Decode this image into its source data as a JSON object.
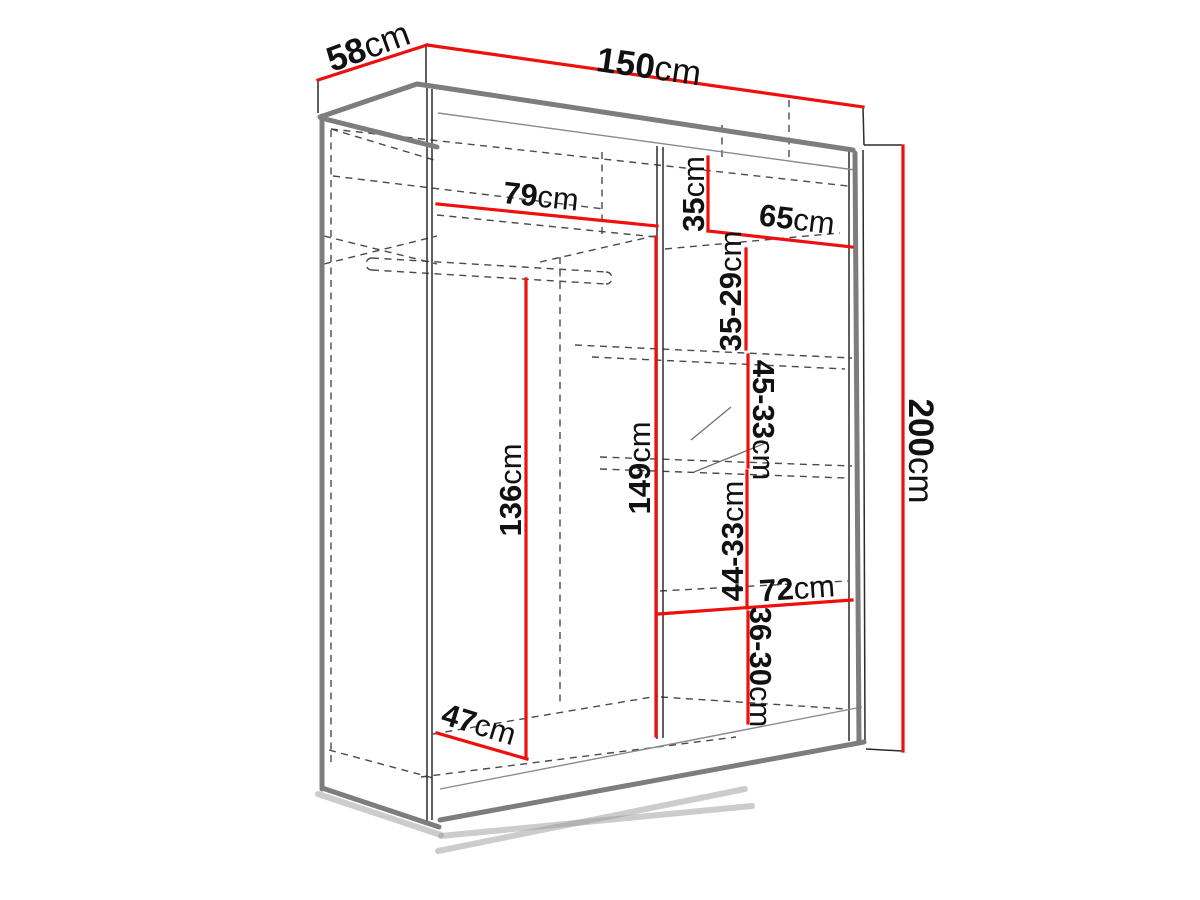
{
  "diagram": {
    "kind": "wardrobe-dimension-diagram",
    "unit": "cm"
  },
  "colors": {
    "dimension": "#ee0f0f",
    "outline": "#7d7d7d",
    "line": "#2b2b2b",
    "dashed": "#4a4a4a",
    "label": "#111111",
    "background": "#ffffff"
  },
  "labels": {
    "depth": {
      "num": "58",
      "unit": "cm"
    },
    "width": {
      "num": "150",
      "unit": "cm"
    },
    "height": {
      "num": "200",
      "unit": "cm"
    },
    "left_shelf_width": {
      "num": "79",
      "unit": "cm"
    },
    "right_shelf_width": {
      "num": "65",
      "unit": "cm"
    },
    "right_top_height": {
      "num": "35",
      "unit": "cm"
    },
    "right_gap_1": {
      "num": "35-29",
      "unit": "cm"
    },
    "right_gap_2": {
      "num": "45-33",
      "unit": "cm"
    },
    "right_gap_3": {
      "num": "44-33",
      "unit": "cm"
    },
    "bottom_shelf_width": {
      "num": "72",
      "unit": "cm"
    },
    "right_gap_4": {
      "num": "36-30",
      "unit": "cm"
    },
    "left_hanging_height": {
      "num": "136",
      "unit": "cm"
    },
    "right_column_height": {
      "num": "149",
      "unit": "cm"
    },
    "floor_depth": {
      "num": "47",
      "unit": "cm"
    }
  }
}
